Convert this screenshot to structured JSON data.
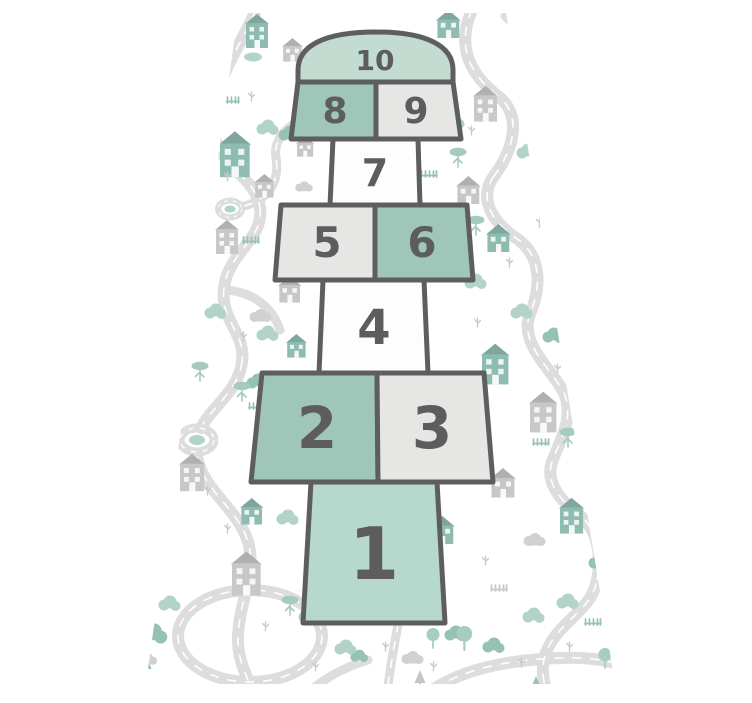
{
  "mat": {
    "cells": [
      {
        "number": "1",
        "color_key": "cell_teal_light"
      },
      {
        "number": "2",
        "color_key": "cell_teal"
      },
      {
        "number": "3",
        "color_key": "cell_grey"
      },
      {
        "number": "4",
        "color_key": "cell_white"
      },
      {
        "number": "5",
        "color_key": "cell_grey"
      },
      {
        "number": "6",
        "color_key": "cell_teal"
      },
      {
        "number": "7",
        "color_key": "cell_white"
      },
      {
        "number": "8",
        "color_key": "cell_teal"
      },
      {
        "number": "9",
        "color_key": "cell_grey"
      },
      {
        "number": "10",
        "color_key": "cell_dome"
      }
    ]
  },
  "colors": {
    "background": "#ffffff",
    "cell_teal": "#9fc6b9",
    "cell_teal_light": "#b7d8cd",
    "cell_dome": "#c2dcd2",
    "cell_grey": "#e6e6e4",
    "cell_white": "#fdfdfd",
    "cell_outline": "#5e5e5e",
    "digit": "#5d5d5d",
    "road": "#dadada",
    "road_dash": "#ffffff",
    "house_grey": "#c2c2c2",
    "house_teal": "#83b5a8",
    "tree_teal": "#a9cfc3",
    "tree_teal_dark": "#8abcae",
    "cloud_grey": "#cdcdcd",
    "mark_grey": "#c4c4c4"
  },
  "icons": [
    "house-icon",
    "tall-house-icon",
    "tree-icon",
    "acacia-tree-icon",
    "round-tree-icon",
    "pine-tree-icon",
    "cloud-icon",
    "fence-icon",
    "grass-icon",
    "roundabout-icon",
    "pond-icon"
  ]
}
